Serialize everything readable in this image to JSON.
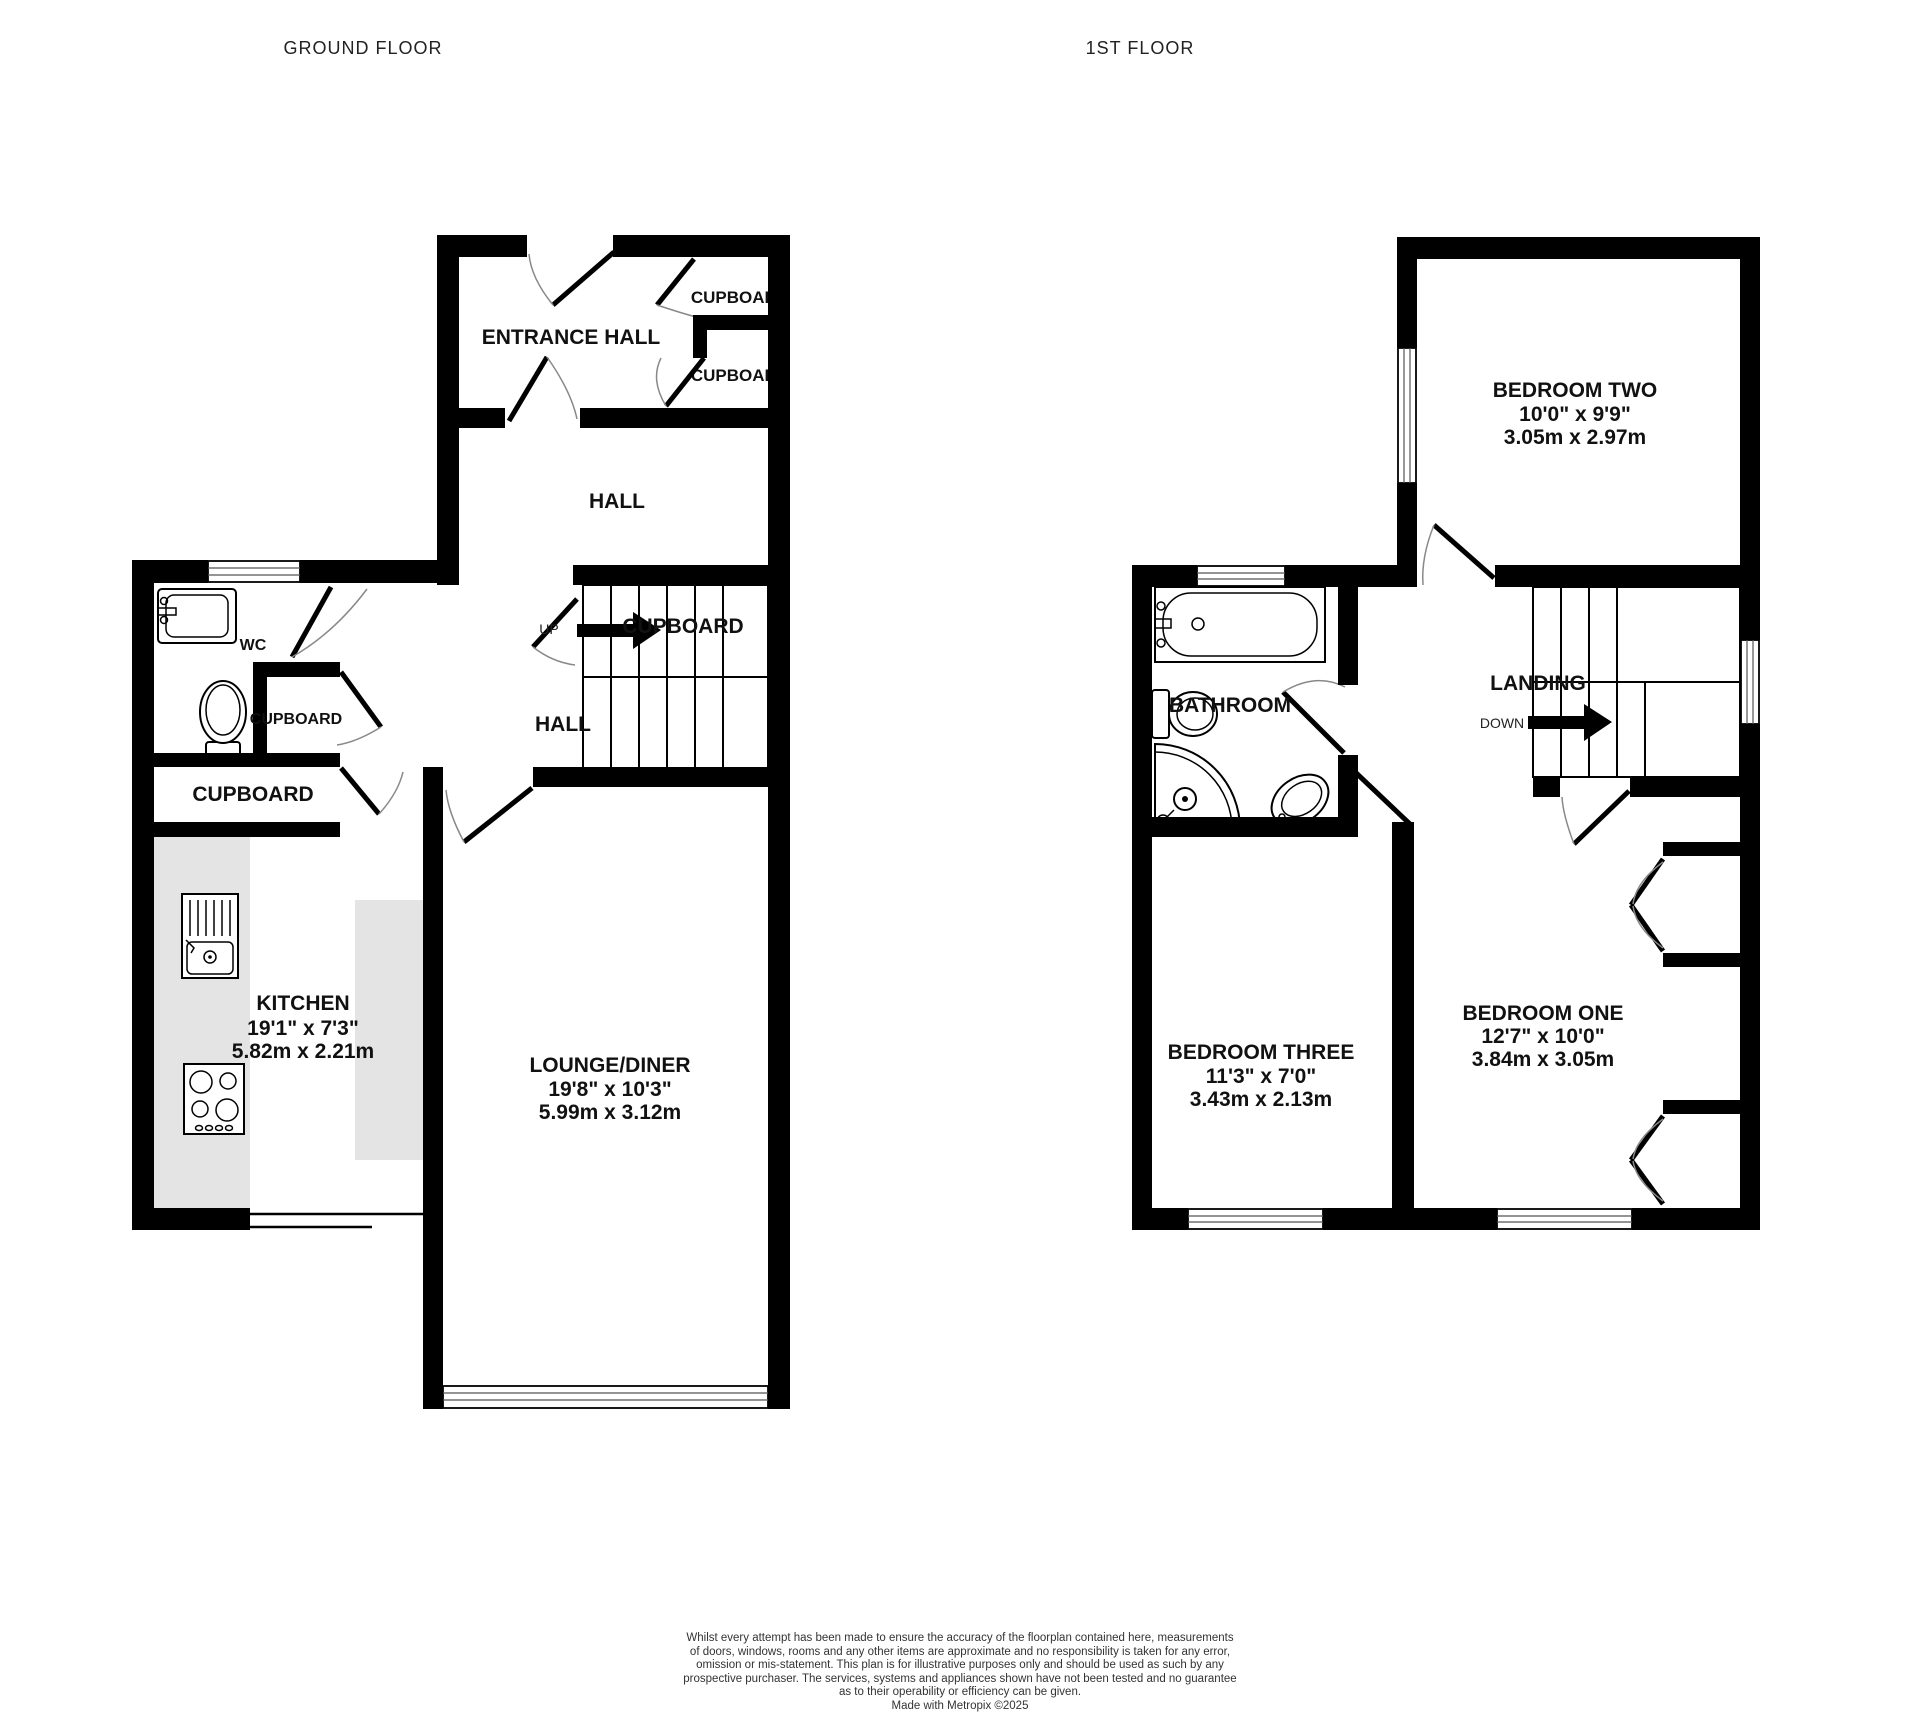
{
  "titles": {
    "ground_floor": "GROUND FLOOR",
    "first_floor": "1ST FLOOR"
  },
  "ground_floor": {
    "entrance_hall": "ENTRANCE HALL",
    "cupboard_upper": "CUPBOARD",
    "cupboard_lower": "CUPBOARD",
    "hall": "HALL",
    "up": "UP",
    "stairs_cupboard": "CUPBOARD",
    "hall_lower": "HALL",
    "wc": "WC",
    "wc_cupboard": "CUPBOARD",
    "cupboard_room": "CUPBOARD",
    "kitchen": {
      "name": "KITCHEN",
      "imperial": "19'1\"  x 7'3\"",
      "metric": "5.82m  x 2.21m"
    },
    "lounge_diner": {
      "name": "LOUNGE/DINER",
      "imperial": "19'8\"  x 10'3\"",
      "metric": "5.99m  x 3.12m"
    }
  },
  "first_floor": {
    "bedroom_two": {
      "name": "BEDROOM TWO",
      "imperial": "10'0\"  x 9'9\"",
      "metric": "3.05m  x 2.97m"
    },
    "bathroom": "BATHROOM",
    "landing": "LANDING",
    "down": "DOWN",
    "bedroom_three": {
      "name": "BEDROOM THREE",
      "imperial": "11'3\"  x 7'0\"",
      "metric": "3.43m  x 2.13m"
    },
    "bedroom_one": {
      "name": "BEDROOM ONE",
      "imperial": "12'7\"  x 10'0\"",
      "metric": "3.84m  x 3.05m"
    }
  },
  "footer": {
    "lines": [
      "Whilst every attempt has been made to ensure the accuracy of the floorplan contained here, measurements",
      "of doors, windows, rooms and any other items are approximate and no responsibility is taken for any error,",
      "omission or mis-statement. This plan is for illustrative purposes only and should be used as such by any",
      "prospective purchaser. The services, systems and appliances shown have not been tested and no guarantee",
      "as to their operability or efficiency can be given.",
      "Made with Metropix ©2025"
    ]
  },
  "colors": {
    "wall": "#000000",
    "counter": "#e4e4e4",
    "door_arc": "#888888",
    "text": "#111111"
  }
}
